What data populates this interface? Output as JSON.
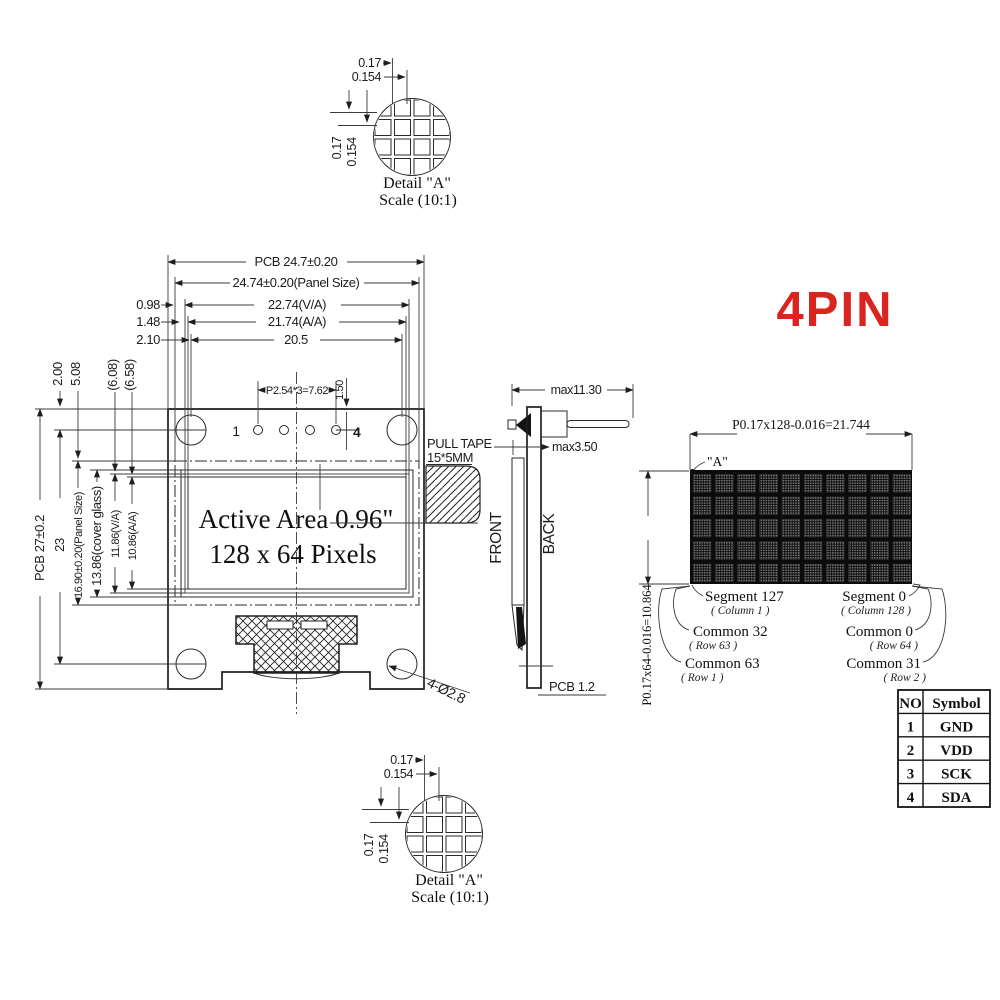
{
  "title": "4PIN",
  "colors": {
    "accent_red": "#da2420",
    "line": "#2a2a2a",
    "matrix_bg": "#0b0b0b",
    "pixel_dot": "#8f8f8f"
  },
  "detail_view": {
    "pitch_h": "0.17",
    "size_h": "0.154",
    "pitch_v": "0.17",
    "size_v": "0.154",
    "label": "Detail \"A\"",
    "scale": "Scale (10:1)"
  },
  "front_view": {
    "dims_top": [
      "PCB 24.7±0.20",
      "24.74±0.20(Panel Size)",
      "22.74(V/A)",
      "21.74(A/A)",
      "20.5"
    ],
    "offsets": [
      "0.98",
      "1.48",
      "2.10"
    ],
    "left_dims": [
      "PCB 27±0.2",
      "23",
      "16.90±0.20(Panel Size)",
      "13.86(cover glass)",
      "11.86(V/A)",
      "10.86(A/A)"
    ],
    "top_stubs": [
      "2.00",
      "5.08",
      "(6.08)",
      "(6.58)"
    ],
    "pins": {
      "first": "1",
      "last": "4",
      "pitch": "P2.54*3=7.62",
      "offset": "1.50"
    },
    "active_area": [
      "Active Area 0.96\"",
      "128 x 64 Pixels"
    ],
    "pull_tape": [
      "PULL TAPE",
      "15*5MM"
    ],
    "hole_note": "4-Ø2.8"
  },
  "side_view": {
    "width": "max11.30",
    "tape": "max3.50",
    "front": "FRONT",
    "back": "BACK",
    "pcb": "PCB 1.2"
  },
  "matrix": {
    "dim_h": "P0.17x128-0.016=21.744",
    "dim_v": "P0.17x64-0.016=10.864",
    "corner": "\"A\"",
    "left": [
      {
        "main": "Segment 127",
        "sub": "( Column 1 )"
      },
      {
        "main": "Common 32",
        "sub": "( Row 63 )"
      },
      {
        "main": "Common 63",
        "sub": "( Row 1 )"
      }
    ],
    "right": [
      {
        "main": "Segment 0",
        "sub": "( Column 128 )"
      },
      {
        "main": "Common 0",
        "sub": "( Row 64 )"
      },
      {
        "main": "Common 31",
        "sub": "( Row 2 )"
      }
    ]
  },
  "pin_table": {
    "headers": [
      "NO",
      "Symbol"
    ],
    "rows": [
      [
        "1",
        "GND"
      ],
      [
        "2",
        "VDD"
      ],
      [
        "3",
        "SCK"
      ],
      [
        "4",
        "SDA"
      ]
    ]
  }
}
